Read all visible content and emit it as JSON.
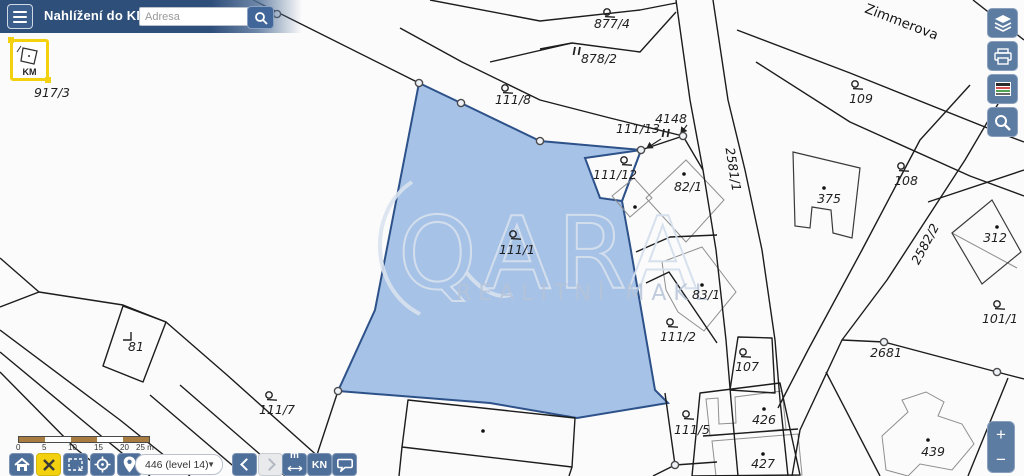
{
  "header": {
    "title": "Nahlížení do KN",
    "search_placeholder": "Adresa"
  },
  "km_tool": {
    "label": "KM"
  },
  "watermark": {
    "brand": "QARA",
    "subtitle": "REALITNÍ MAKL"
  },
  "map": {
    "street_labels": [
      {
        "text": "Zimmerova",
        "x": 900,
        "y": 26,
        "rot": 21,
        "size": 13.5
      }
    ],
    "road_labels": [
      {
        "text": "2581/1",
        "x": 729,
        "y": 170,
        "rot": 81,
        "size": 12.5
      },
      {
        "text": "2582/2",
        "x": 929,
        "y": 246,
        "rot": -62,
        "size": 12.5
      }
    ],
    "parcel_labels": [
      {
        "t": "917/3",
        "x": 52,
        "y": 97
      },
      {
        "t": "877/4",
        "x": 612,
        "y": 28,
        "sym": "ct",
        "sx": 607,
        "sy": 12
      },
      {
        "t": "878/2",
        "x": 599,
        "y": 63,
        "sym": "bars",
        "sx": 577,
        "sy": 51
      },
      {
        "t": "111/8",
        "x": 513,
        "y": 104,
        "sym": "ct",
        "sx": 505,
        "sy": 88
      },
      {
        "t": "111/13",
        "x": 638,
        "y": 133
      },
      {
        "t": "4148",
        "x": 671,
        "y": 123
      },
      {
        "t": "",
        "x": 0,
        "y": 0,
        "sym": "bars",
        "sx": 666,
        "sy": 133
      },
      {
        "t": "109",
        "x": 861,
        "y": 103,
        "sym": "ct",
        "sx": 855,
        "sy": 84
      },
      {
        "t": "108",
        "x": 906,
        "y": 185,
        "sym": "ct",
        "sx": 901,
        "sy": 166
      },
      {
        "t": "375",
        "x": 829,
        "y": 203,
        "sym": "dot",
        "sx": 824,
        "sy": 188
      },
      {
        "t": "312",
        "x": 995,
        "y": 242,
        "sym": "dot",
        "sx": 997,
        "sy": 227
      },
      {
        "t": "101/1",
        "x": 1000,
        "y": 323,
        "sym": "ct",
        "sx": 997,
        "sy": 304
      },
      {
        "t": "2681",
        "x": 886,
        "y": 357
      },
      {
        "t": "82/1",
        "x": 688,
        "y": 191,
        "sym": "dot",
        "sx": 684,
        "sy": 174
      },
      {
        "t": "",
        "x": 0,
        "y": 0,
        "sym": "dot",
        "sx": 635,
        "sy": 207
      },
      {
        "t": "83/1",
        "x": 706,
        "y": 299,
        "sym": "dot",
        "sx": 702,
        "sy": 285
      },
      {
        "t": "111/12",
        "x": 615,
        "y": 179,
        "sym": "ct",
        "sx": 624,
        "sy": 160
      },
      {
        "t": "111/1",
        "x": 517,
        "y": 254,
        "sym": "ct",
        "sx": 513,
        "sy": 234
      },
      {
        "t": "111/2",
        "x": 678,
        "y": 341,
        "sym": "ct",
        "sx": 670,
        "sy": 322
      },
      {
        "t": "107",
        "x": 747,
        "y": 371,
        "sym": "ct",
        "sx": 743,
        "sy": 352
      },
      {
        "t": "81",
        "x": 136,
        "y": 351,
        "sym": "corner",
        "sx": 128,
        "sy": 336
      },
      {
        "t": "111/7",
        "x": 277,
        "y": 414,
        "sym": "ct",
        "sx": 269,
        "sy": 395
      },
      {
        "t": "111/5",
        "x": 692,
        "y": 434,
        "sym": "ct",
        "sx": 686,
        "sy": 414
      },
      {
        "t": "426",
        "x": 764,
        "y": 424,
        "sym": "dot",
        "sx": 764,
        "sy": 409
      },
      {
        "t": "427",
        "x": 763,
        "y": 468,
        "sym": "dot",
        "sx": 763,
        "sy": 454
      },
      {
        "t": "439",
        "x": 933,
        "y": 456,
        "sym": "dot",
        "sx": 928,
        "sy": 440
      },
      {
        "t": "",
        "x": 0,
        "y": 0,
        "sym": "dot",
        "sx": 483,
        "sy": 431
      }
    ]
  },
  "scale_bar": {
    "ticks": [
      "0",
      "5",
      "10",
      "15",
      "20",
      "25 m"
    ]
  },
  "bottom_toolbar": {
    "dropdown_value": "446 (level 14)",
    "measure_label": "m",
    "kn_label": "KN"
  },
  "zoom_control": {
    "plus": "+",
    "minus": "−"
  },
  "colors": {
    "highlight_fill": "#a6c2e7",
    "highlight_stroke": "#2d5189",
    "toolbar_blue": "#5d7ca2",
    "accent_yellow": "#f4d10e",
    "header_blue": "#2f4f7b"
  }
}
